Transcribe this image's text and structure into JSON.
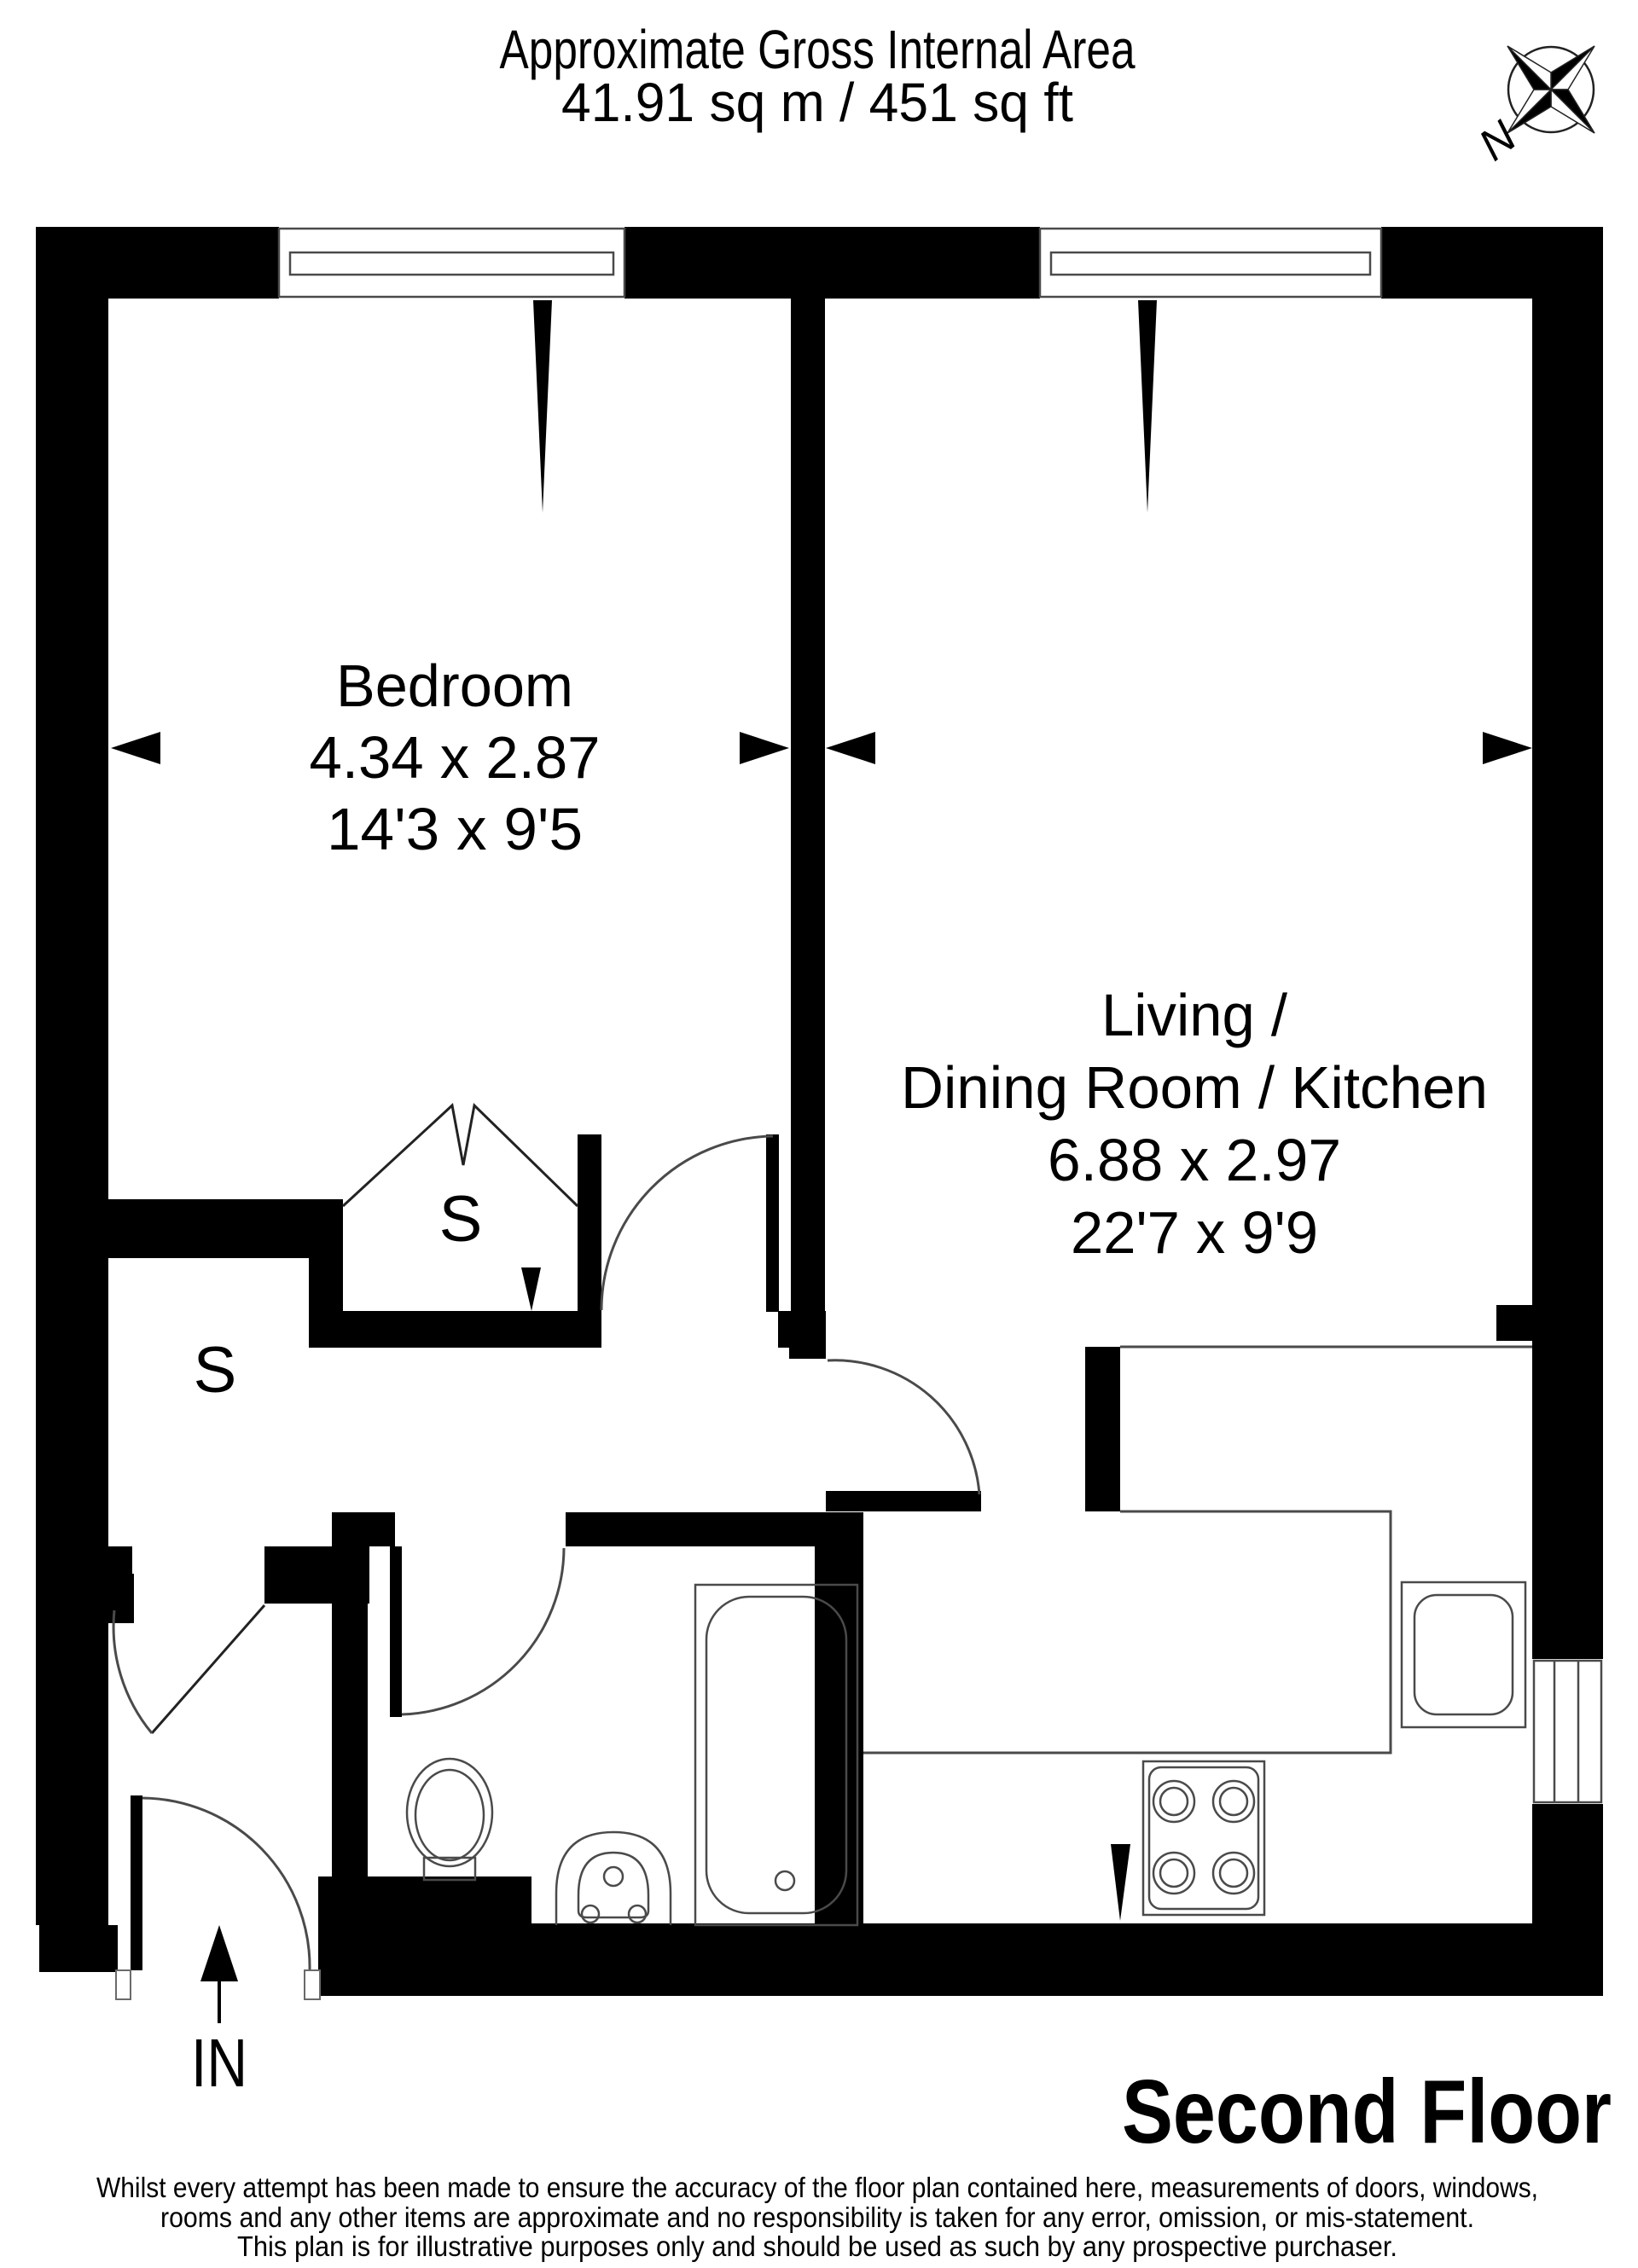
{
  "header": {
    "line1": "Approximate Gross Internal Area",
    "line2": "41.91 sq m / 451 sq ft"
  },
  "compass": {
    "north": "N"
  },
  "rooms": {
    "bedroom": {
      "name": "Bedroom",
      "metric": "4.34 x 2.87",
      "imperial": "14'3 x 9'5"
    },
    "living": {
      "line1": "Living /",
      "line2": "Dining Room / Kitchen",
      "metric": "6.88 x 2.97",
      "imperial": "22'7 x 9'9"
    }
  },
  "closets": {
    "left": "S",
    "middle": "S"
  },
  "entrance": {
    "label": "IN"
  },
  "floor": {
    "label": "Second Floor"
  },
  "disclaimer": {
    "line1": "Whilst every attempt has been made to ensure the accuracy of the floor plan contained here, measurements of doors, windows,",
    "line2": "rooms and any other items are approximate and no responsibility is taken for any error, omission, or mis-statement.",
    "line3": "This plan is for illustrative purposes only and should be used as such by any prospective purchaser."
  },
  "colors": {
    "wall": "#000000",
    "line": "#4a4a4a",
    "background": "#ffffff"
  }
}
